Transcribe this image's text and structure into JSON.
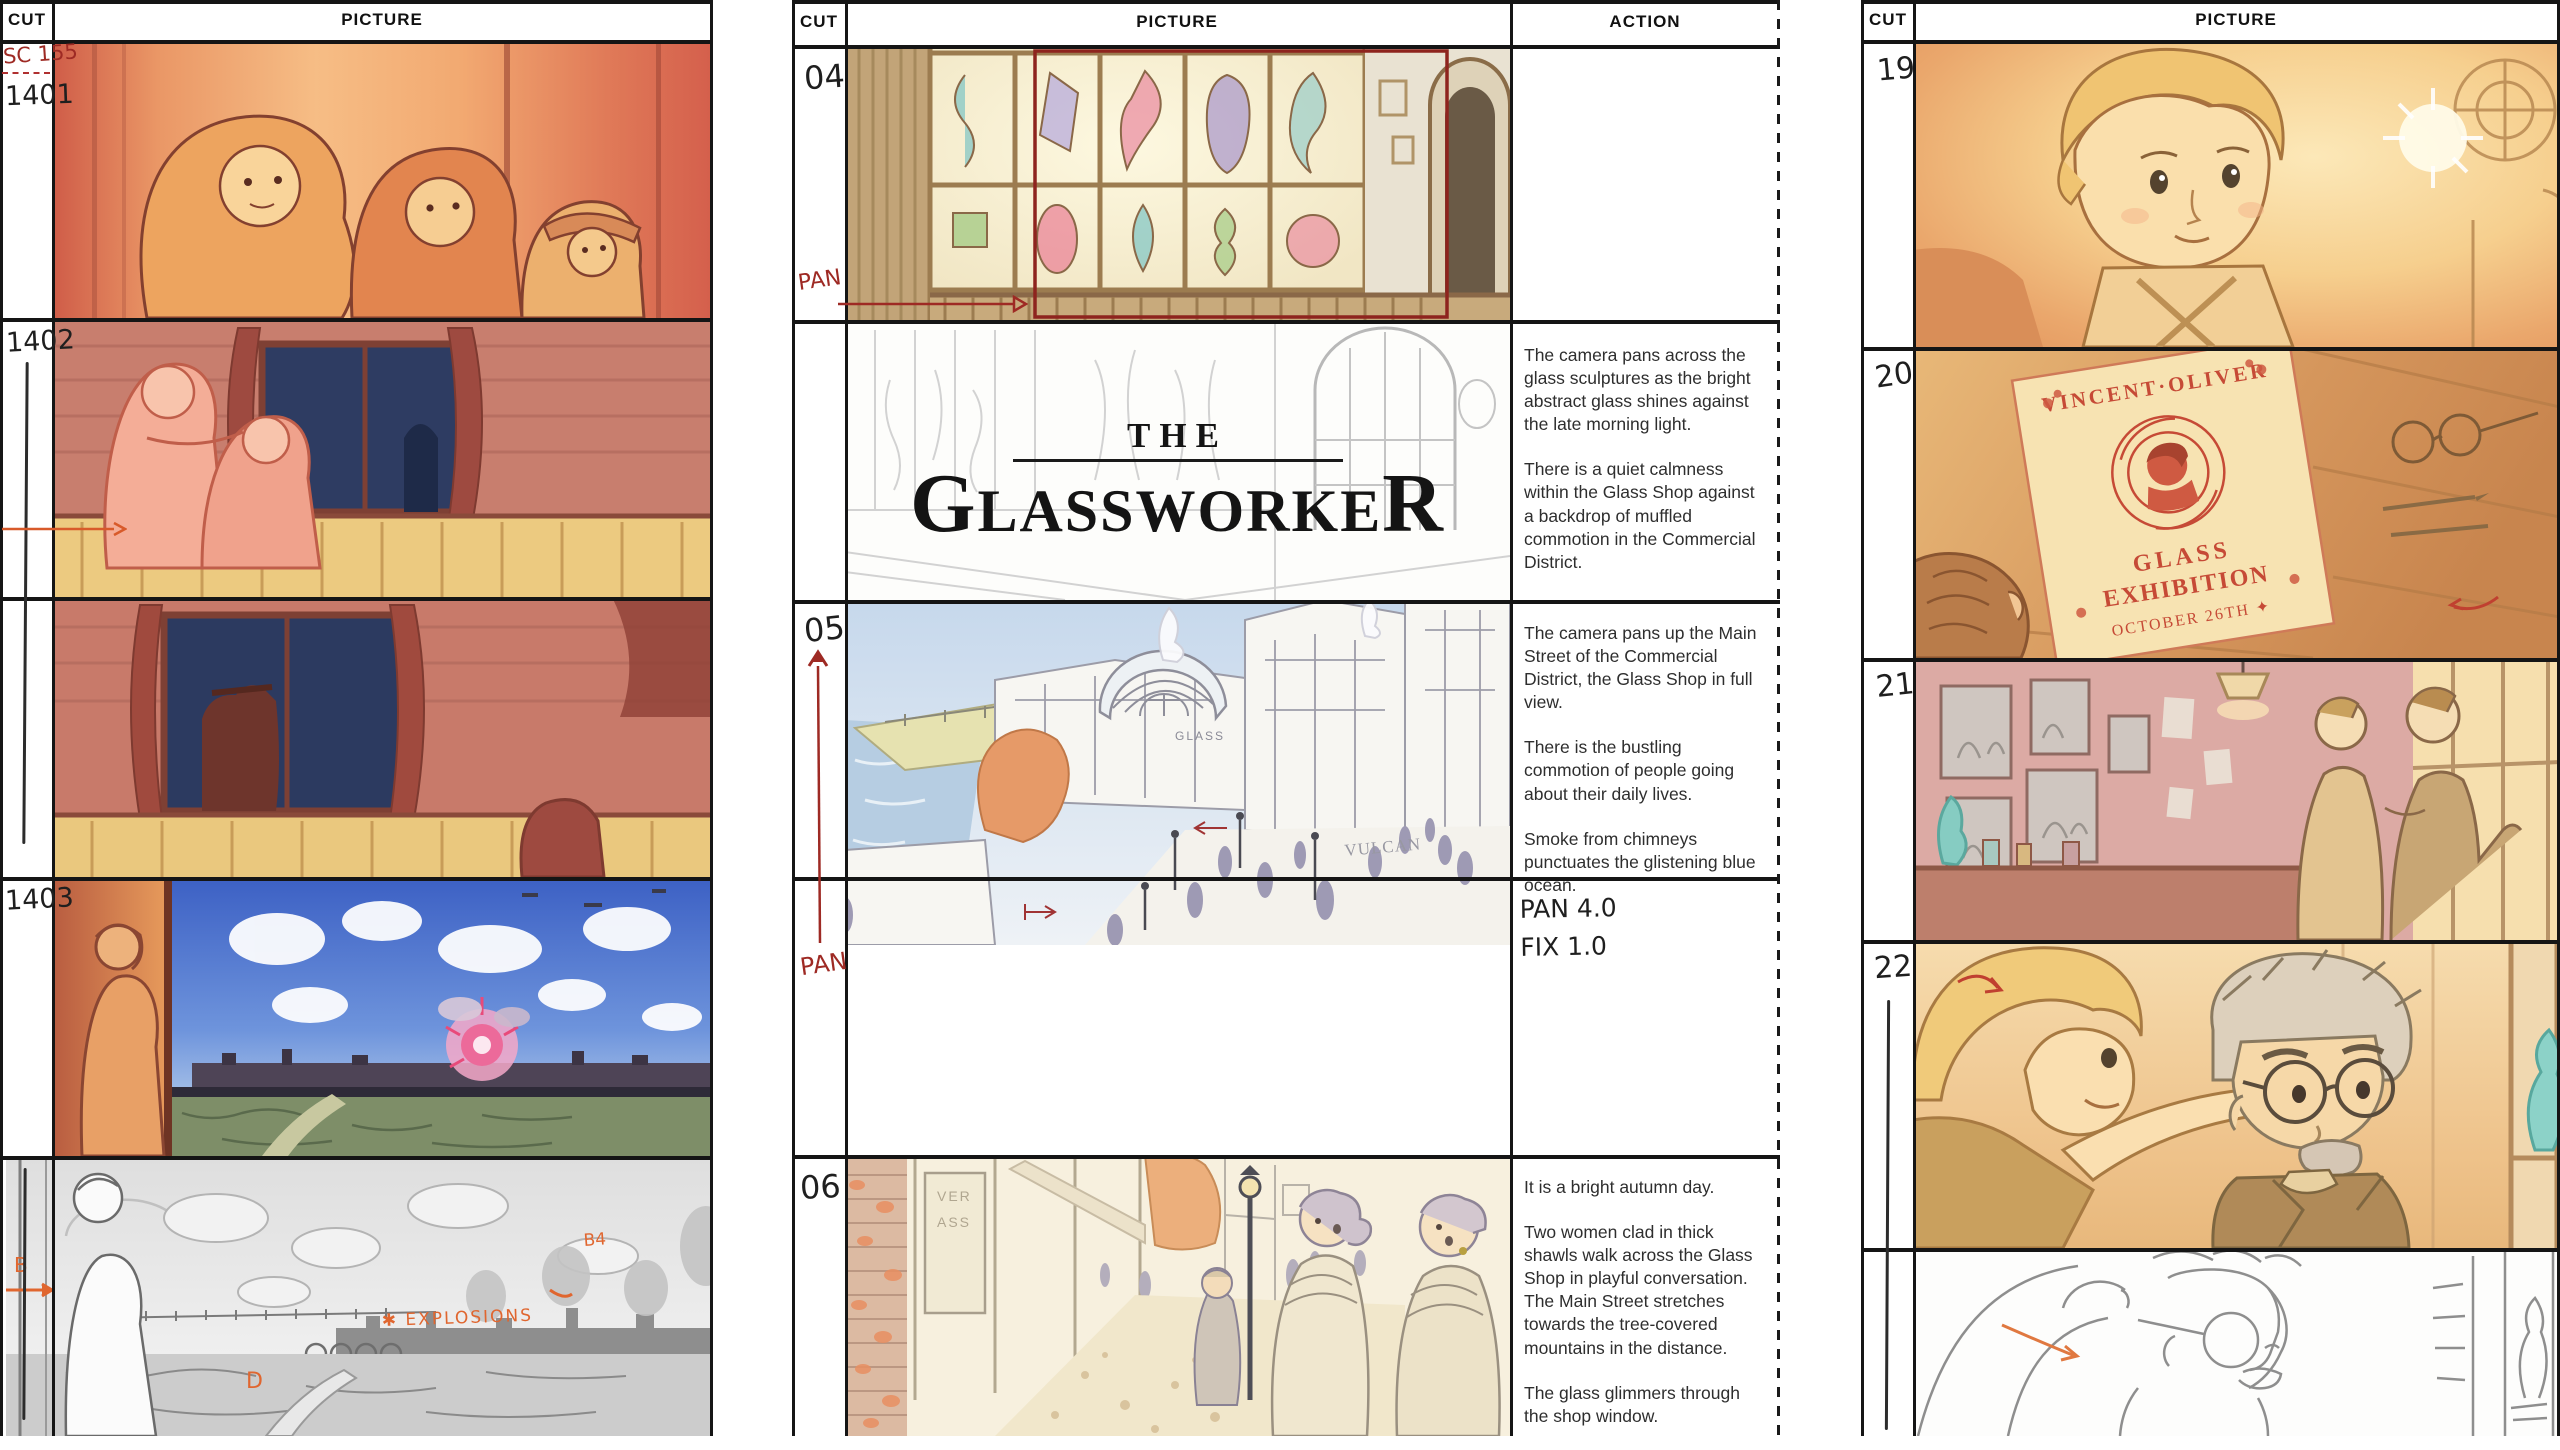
{
  "film": {
    "the": "THE",
    "g": "G",
    "mid": "LASSWORKE",
    "r": "R"
  },
  "headers": {
    "cut": "CUT",
    "picture": "PICTURE",
    "action": "ACTION"
  },
  "left": {
    "scene_label": "SC 155",
    "cut1": "1401",
    "cut2": "1402",
    "cut4": "1403",
    "ann_b": "B",
    "ann_b4": "B4",
    "ann_d": "D",
    "ann_explosions": "✱ EXPLOSIONS"
  },
  "middle": {
    "cut1": "04",
    "cut3": "05",
    "cut5": "06",
    "pan_label_04": "PAN",
    "pan_label_05": "PAN",
    "hand_line1": "PAN 4.0",
    "hand_line2": "FIX 1.0",
    "action_title_p1": "The camera pans across the glass sculptures as the bright abstract glass shines against the late morning light.",
    "action_title_p2": "There is a quiet calmness within the Glass Shop against a backdrop of muffled commotion in the Commercial District.",
    "action_05_p1": "The camera pans up the Main Street of the Commercial District, the Glass Shop in full view.",
    "action_05_p2": "There is the bustling commotion of people going about their daily lives.",
    "action_05_p3": "Smoke from chimneys punctuates the glistening blue ocean.",
    "action_06_p1": "It is a bright autumn day.",
    "action_06_p2": "Two women clad in thick shawls walk across the Glass Shop in playful conversation. The Main Street stretches towards the tree-covered mountains in the distance.",
    "action_06_p3": "The glass glimmers through the shop window.",
    "sign_glass": "GLASS",
    "sign_vulcan": "VULCAN",
    "shop_sign_a": "VER",
    "shop_sign_b": "ASS"
  },
  "right": {
    "cut1": "19",
    "cut2": "20",
    "cut3": "21",
    "cut4": "22",
    "poster_l1": "VINCENT·OLIVER",
    "poster_l2": "GLASS",
    "poster_l3": "EXHIBITION",
    "poster_l4": "OCTOBER 26TH ✦"
  },
  "colors": {
    "ink_red": "#9e2a24",
    "annotation_orange": "#e0662f",
    "poster_red": "#c64a36",
    "night_blue": "#2e3c62",
    "sky_blue": "#4166c8"
  }
}
